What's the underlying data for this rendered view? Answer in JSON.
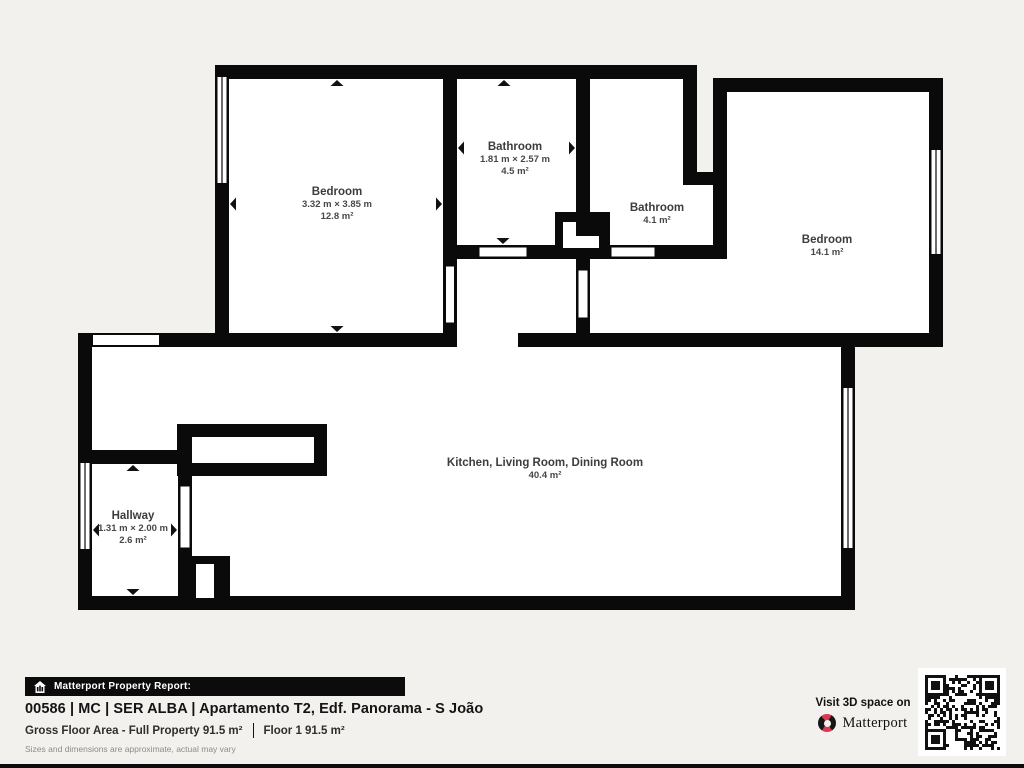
{
  "colors": {
    "background": "#f2f1ee",
    "wall": "#0a0a0a",
    "room_fill": "#ffffff",
    "label_text": "#3d3d3d",
    "brand_red": "#d93a52"
  },
  "plan": {
    "rooms": [
      {
        "id": "bedroom-1",
        "name": "Bedroom",
        "dims": "3.32 m × 3.85 m",
        "area": "12.8 m²"
      },
      {
        "id": "bathroom-1",
        "name": "Bathroom",
        "dims": "1.81 m × 2.57 m",
        "area": "4.5 m²"
      },
      {
        "id": "bathroom-2",
        "name": "Bathroom",
        "dims": "",
        "area": "4.1 m²"
      },
      {
        "id": "bedroom-2",
        "name": "Bedroom",
        "dims": "",
        "area": "14.1 m²"
      },
      {
        "id": "kitchen-living-dining",
        "name": "Kitchen, Living Room, Dining Room",
        "dims": "",
        "area": "40.4 m²"
      },
      {
        "id": "hallway",
        "name": "Hallway",
        "dims": "1.31 m × 2.00 m",
        "area": "2.6 m²"
      }
    ]
  },
  "footer": {
    "report_bar": "Matterport Property Report:",
    "title": "00586 | MC | SER ALBA | Apartamento T2, Edf. Panorama - S João",
    "gross_area": "Gross Floor Area - Full Property 91.5 m²",
    "floor_area": "Floor 1 91.5 m²",
    "disclaimer": "Sizes and dimensions are approximate, actual may vary",
    "visit": "Visit 3D space on",
    "brand": "Matterport"
  }
}
